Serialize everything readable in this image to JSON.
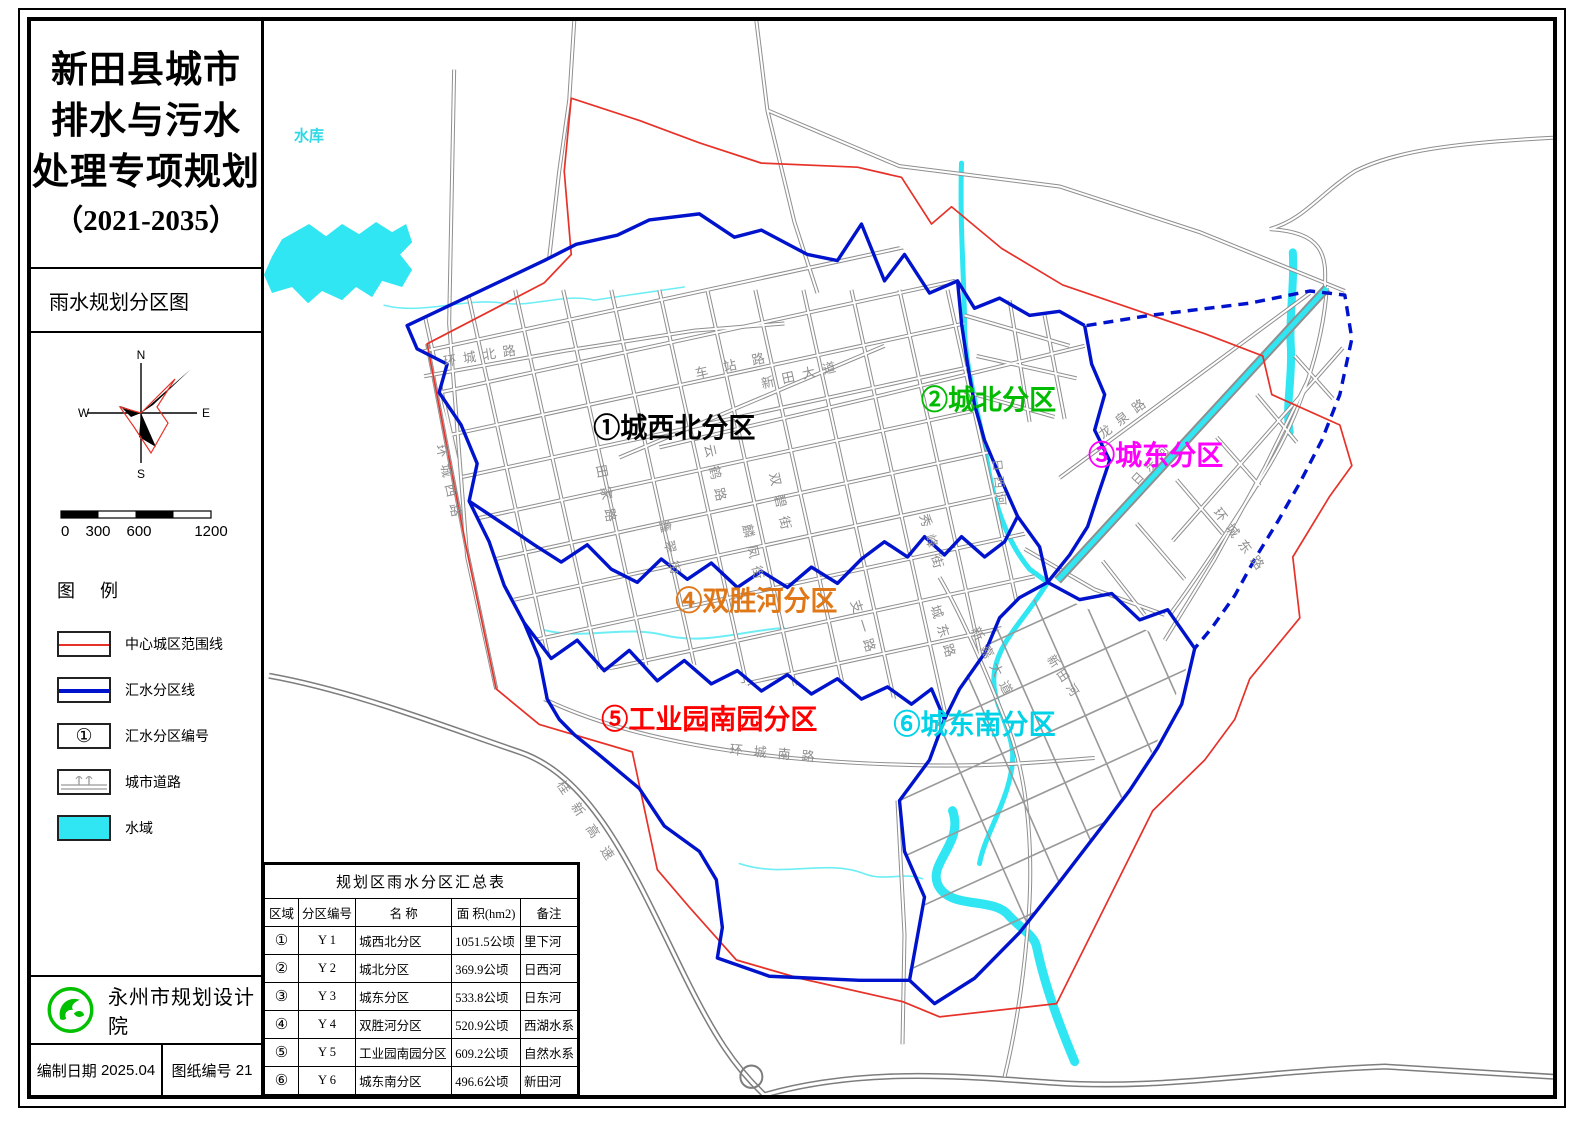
{
  "title_block": {
    "line1": "新田县城市",
    "line2": "排水与污水",
    "line3": "处理专项规划",
    "line4": "（2021-2035）"
  },
  "map_name": "雨水规划分区图",
  "compass": {
    "n": "N",
    "s": "S",
    "e": "E",
    "w": "W"
  },
  "scale": {
    "ticks": [
      "0",
      "300",
      "600",
      "1200"
    ]
  },
  "legend": {
    "header": "图 例",
    "items": [
      {
        "label": "中心城区范围线",
        "type": "red-line",
        "color": "#e63229"
      },
      {
        "label": "汇水分区线",
        "type": "blue-line",
        "color": "#0013cc"
      },
      {
        "label": "汇水分区编号",
        "type": "circle-number",
        "symbol": "①"
      },
      {
        "label": "城市道路",
        "type": "road"
      },
      {
        "label": "水域",
        "type": "water",
        "color": "#2fe6f2"
      }
    ]
  },
  "publisher": {
    "name": "永州市规划设计院",
    "logo_color": "#00c000"
  },
  "footer": {
    "date_label": "编制日期",
    "date": "2025.04",
    "sheet_label": "图纸编号",
    "sheet": "21"
  },
  "map": {
    "reservoir_label": "水库",
    "zones": [
      {
        "id": "①",
        "code": "Y 1",
        "name": "城西北分区",
        "label": "①城西北分区",
        "color": "#000000"
      },
      {
        "id": "②",
        "code": "Y 2",
        "name": "城北分区",
        "label": "②城北分区",
        "color": "#00bb00"
      },
      {
        "id": "③",
        "code": "Y 3",
        "name": "城东分区",
        "label": "③城东分区",
        "color": "#ff00ff"
      },
      {
        "id": "④",
        "code": "Y 4",
        "name": "双胜河分区",
        "label": "④双胜河分区",
        "color": "#e07818"
      },
      {
        "id": "⑤",
        "code": "Y 5",
        "name": "工业园南园分区",
        "label": "⑤工业园南园分区",
        "color": "#ff0000"
      },
      {
        "id": "⑥",
        "code": "Y 6",
        "name": "城东南分区",
        "label": "⑥城东南分区",
        "color": "#00d2e8"
      }
    ],
    "roads": [
      "环城北路",
      "环城西路",
      "车站路",
      "新田大道",
      "田家路",
      "云鹤路",
      "双碧街",
      "鑫翠街",
      "麟凤街",
      "秀峰街",
      "支一路",
      "城东路",
      "龙泉路",
      "日东河",
      "环城东路",
      "环城南路",
      "桂新高速",
      "新嘉大道",
      "新田河",
      "日西河"
    ]
  },
  "table": {
    "title": "规划区雨水分区汇总表",
    "headers": [
      "区域",
      "分区编号",
      "名  称",
      "面  积(hm2)",
      "备注"
    ],
    "rows": [
      [
        "①",
        "Y 1",
        "城西北分区",
        "1051.5公顷",
        "里下河"
      ],
      [
        "②",
        "Y 2",
        "城北分区",
        "369.9公顷",
        "日西河"
      ],
      [
        "③",
        "Y 3",
        "城东分区",
        "533.8公顷",
        "日东河"
      ],
      [
        "④",
        "Y 4",
        "双胜河分区",
        "520.9公顷",
        "西湖水系"
      ],
      [
        "⑤",
        "Y 5",
        "工业园南园分区",
        "609.2公顷",
        "自然水系"
      ],
      [
        "⑥",
        "Y 6",
        "城东南分区",
        "496.6公顷",
        "新田河"
      ]
    ]
  }
}
